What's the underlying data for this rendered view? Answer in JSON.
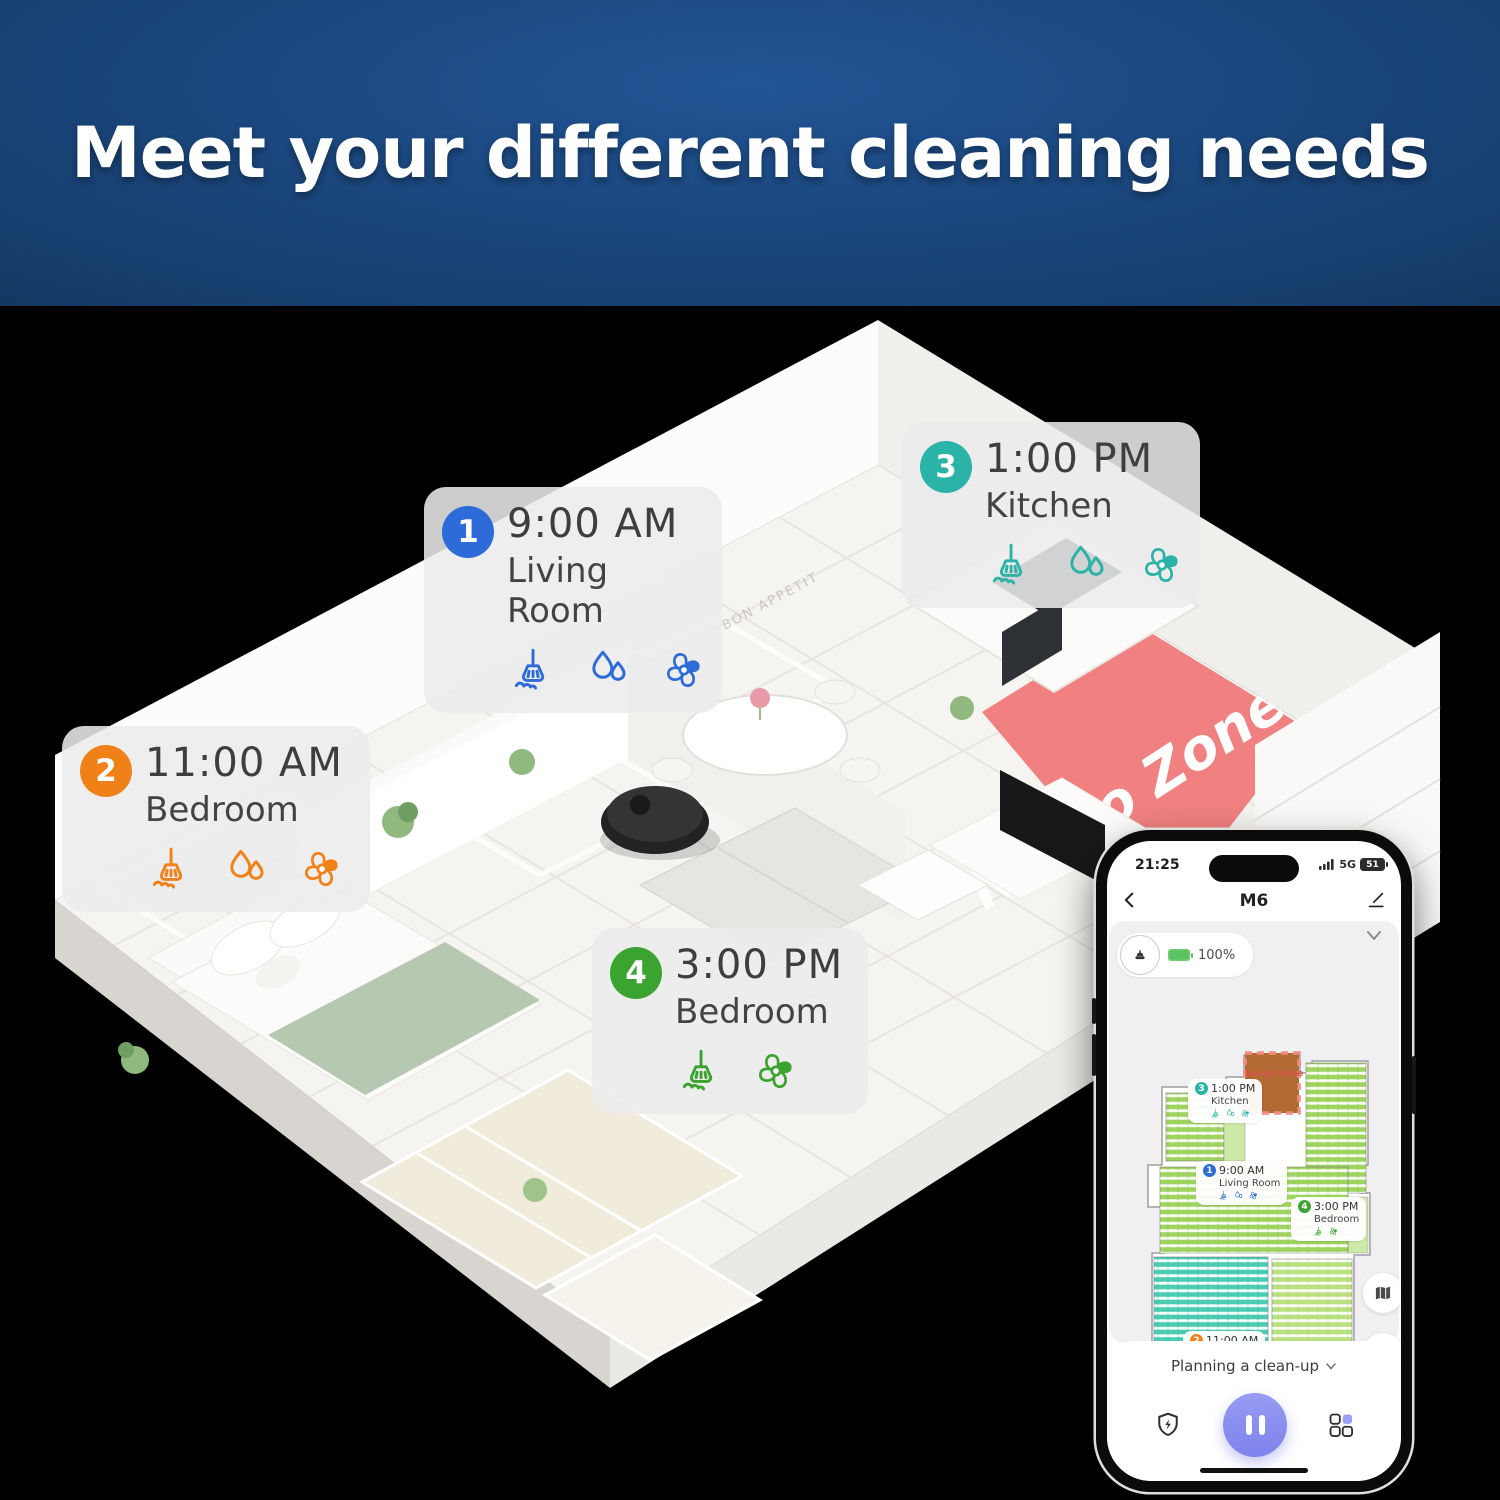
{
  "banner": {
    "title": "Meet your different cleaning needs"
  },
  "floorplan": {
    "no_go_label": "No-go Zone!",
    "wall_art": "BON APPETIT",
    "labels": [
      {
        "num": "1",
        "time": "9:00 AM",
        "room": "Living Room",
        "color": "#2d6bd9",
        "icons": [
          "broom-icon",
          "water-drops-icon",
          "fan-icon"
        ]
      },
      {
        "num": "2",
        "time": "11:00 AM",
        "room": "Bedroom",
        "color": "#f08119",
        "icons": [
          "broom-icon",
          "water-drops-icon",
          "fan-icon"
        ]
      },
      {
        "num": "3",
        "time": "1:00 PM",
        "room": "Kitchen",
        "color": "#2ab3a6",
        "icons": [
          "broom-icon",
          "water-drops-icon",
          "fan-icon"
        ]
      },
      {
        "num": "4",
        "time": "3:00 PM",
        "room": "Bedroom",
        "color": "#3ba32f",
        "icons": [
          "broom-icon",
          "fan-icon"
        ]
      }
    ]
  },
  "phone": {
    "status_bar": {
      "time": "21:25",
      "network": "5G",
      "battery_percent": "51"
    },
    "nav": {
      "title": "M6"
    },
    "robot_pill": {
      "battery": "100%"
    },
    "map": {
      "no_go_label": "No-go Zone",
      "markers": [
        {
          "num": "1",
          "time": "9:00 AM",
          "room": "Living Room",
          "color": "#2d6bd9",
          "icons": [
            "broom-icon",
            "water-drops-icon",
            "fan-icon"
          ]
        },
        {
          "num": "2",
          "time": "11:00 AM",
          "room": "Bedroom",
          "color": "#f08119",
          "icons": [
            "broom-icon",
            "water-drops-icon",
            "fan-icon"
          ]
        },
        {
          "num": "3",
          "time": "1:00 PM",
          "room": "Kitchen",
          "color": "#2ab3a6",
          "icons": [
            "broom-icon",
            "water-drops-icon",
            "fan-icon"
          ]
        },
        {
          "num": "4",
          "time": "3:00 PM",
          "room": "Bedroom",
          "color": "#3ba32f",
          "icons": [
            "broom-icon",
            "fan-icon"
          ]
        }
      ]
    },
    "controls": {
      "mode_label": "Planning a clean-up"
    }
  },
  "colors": {
    "accent_blue": "#2d6bd9",
    "accent_orange": "#f08119",
    "accent_teal": "#2ab3a6",
    "accent_green": "#3ba32f",
    "no_go_red": "#f0797a",
    "map_room_green": "#9fd35f",
    "map_room_teal": "#4bccb2",
    "map_no_go_fill": "#b26a33",
    "map_no_go_border": "#f28b82",
    "pause_purple": "#8589ee",
    "battery_green": "#5ac262",
    "banner_blue": "#1d4e87"
  },
  "icons": {
    "schedule_icons": [
      "broom-icon",
      "water-drops-icon",
      "fan-icon"
    ],
    "phone_icons": [
      "back-icon",
      "edit-icon",
      "chevron-down-icon",
      "signal-icon",
      "battery-icon",
      "robot-icon",
      "map-icon",
      "diamonds-icon",
      "shield-bolt-icon",
      "pause-icon",
      "room-grid-icon"
    ]
  }
}
